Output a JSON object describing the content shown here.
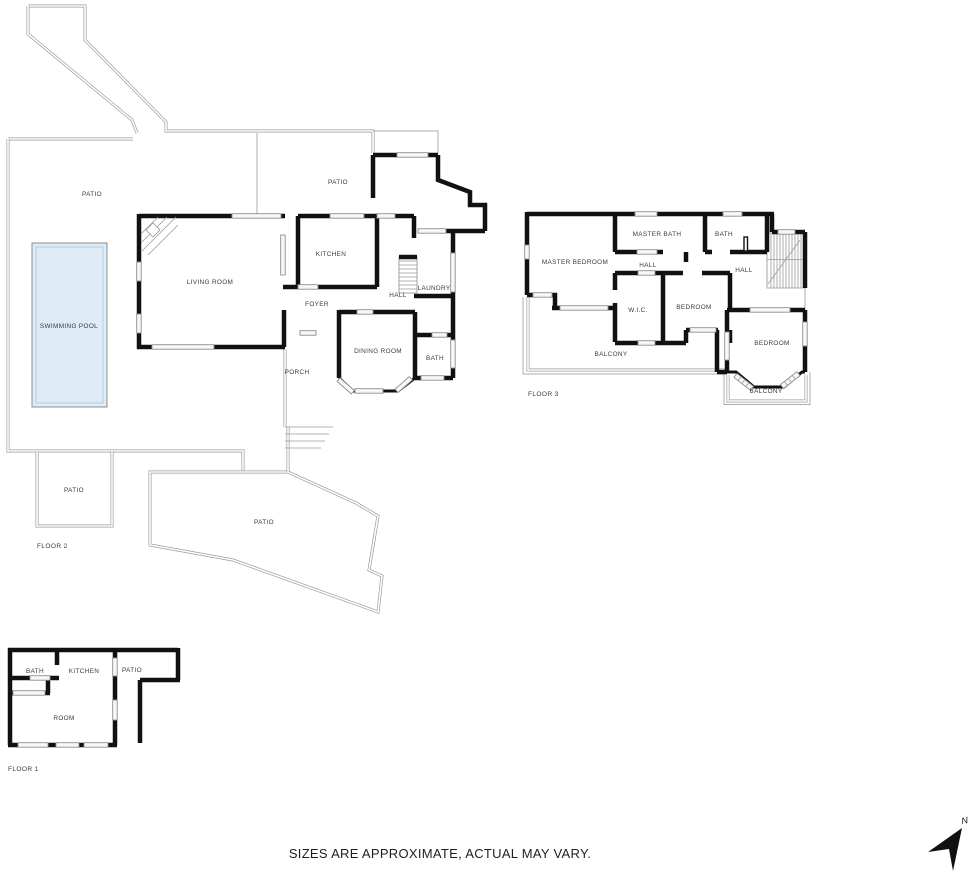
{
  "disclaimer": "SIZES ARE APPROXIMATE, ACTUAL MAY VARY.",
  "compass": {
    "label": "N"
  },
  "colors": {
    "wall": "#111111",
    "outline": "#9b9b9b",
    "pool_fill": "#dfecf7",
    "window": "#8f8f8f",
    "label": "#3a3a3a"
  },
  "floor2": {
    "name": "FLOOR 2",
    "rooms": [
      "PATIO",
      "PATIO",
      "SWIMMING POOL",
      "LIVING ROOM",
      "KITCHEN",
      "FOYER",
      "HALL",
      "LAUNDRY",
      "DINING ROOM",
      "BATH",
      "PORCH",
      "PATIO",
      "PATIO"
    ]
  },
  "floor3": {
    "name": "FLOOR 3",
    "rooms": [
      "MASTER BEDROOM",
      "MASTER BATH",
      "BATH",
      "HALL",
      "HALL",
      "W.I.C.",
      "BEDROOM",
      "BEDROOM",
      "BALCONY",
      "BALCONY"
    ]
  },
  "floor1": {
    "name": "FLOOR 1",
    "rooms": [
      "BATH",
      "KITCHEN",
      "PATIO",
      "ROOM"
    ]
  }
}
